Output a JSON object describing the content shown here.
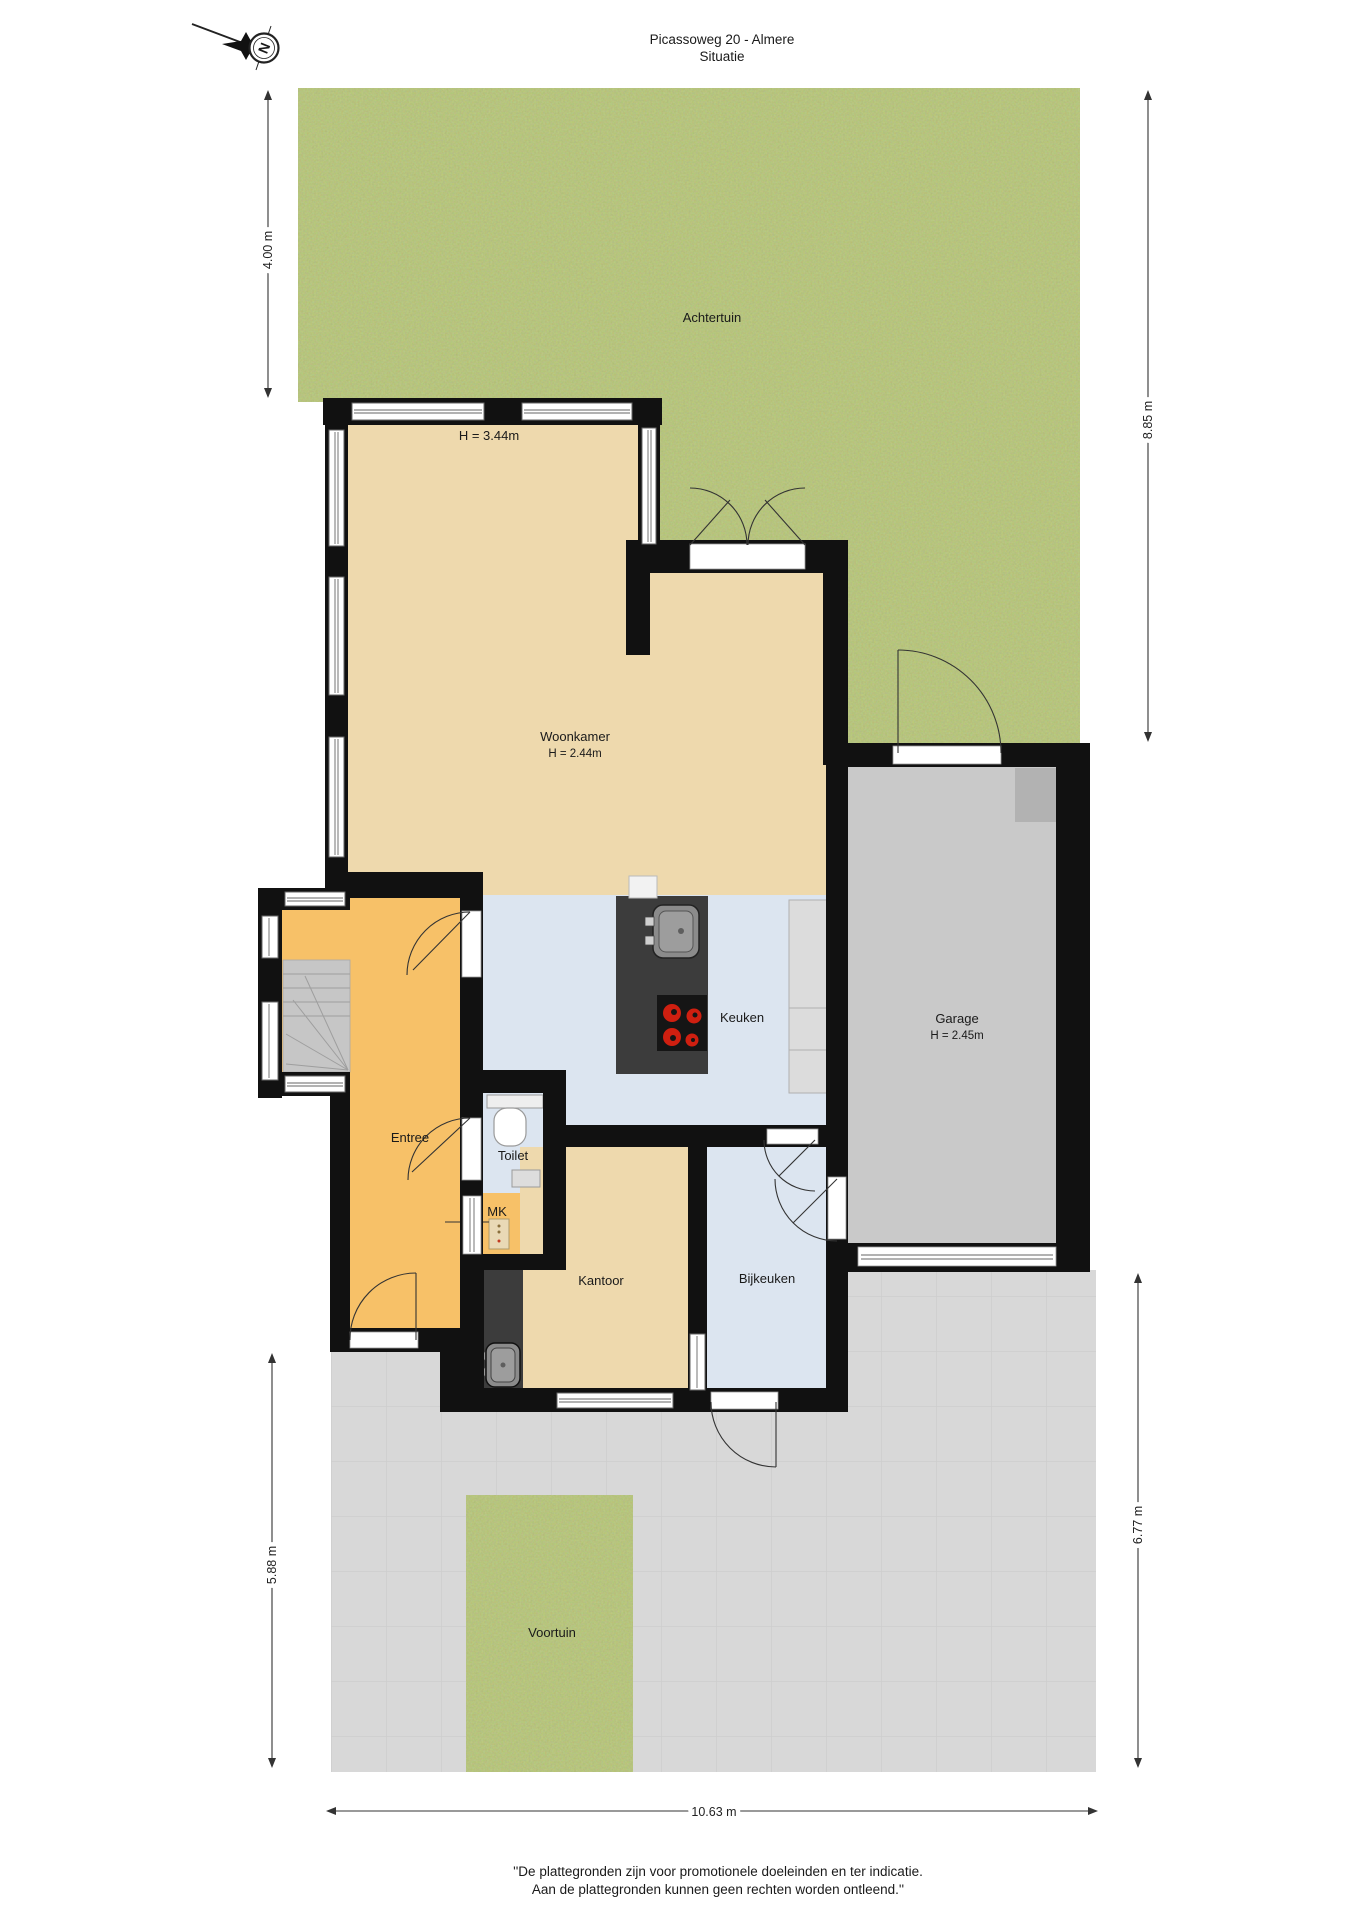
{
  "title": {
    "line1": "Picassoweg 20 - Almere",
    "line2": "Situatie"
  },
  "compass": {
    "north": "N"
  },
  "labels": {
    "achtertuin": "Achtertuin",
    "serre_height": "H = 3.44m",
    "woonkamer": "Woonkamer",
    "woonkamer_height": "H = 2.44m",
    "keuken": "Keuken",
    "garage": "Garage",
    "garage_height": "H = 2.45m",
    "entree": "Entree",
    "toilet": "Toilet",
    "mk": "MK",
    "kantoor": "Kantoor",
    "bijkeuken": "Bijkeuken",
    "voortuin": "Voortuin"
  },
  "dimensions": {
    "backyard_depth": "4.00 m",
    "right_side": "8.85 m",
    "front_left": "5.88 m",
    "front_right": "6.77 m",
    "plot_width": "10.63 m"
  },
  "footer": {
    "line1": "''De plattegronden zijn voor promotionele doeleinden en ter indicatie.",
    "line2": "Aan de plattegronden kunnen geen rechten worden ontleend.''"
  },
  "colors": {
    "grass": "#78903a",
    "paving": "#d8d8d8",
    "paving_grid": "#cccccc",
    "wall": "#111111",
    "living_floor": "#eed9ad",
    "entry_floor": "#f7c168",
    "kitchen_floor": "#dce5f0",
    "garage_floor": "#c9c9c9",
    "counter_dark": "#3c3c3c",
    "burner_red": "#cf1f10"
  }
}
